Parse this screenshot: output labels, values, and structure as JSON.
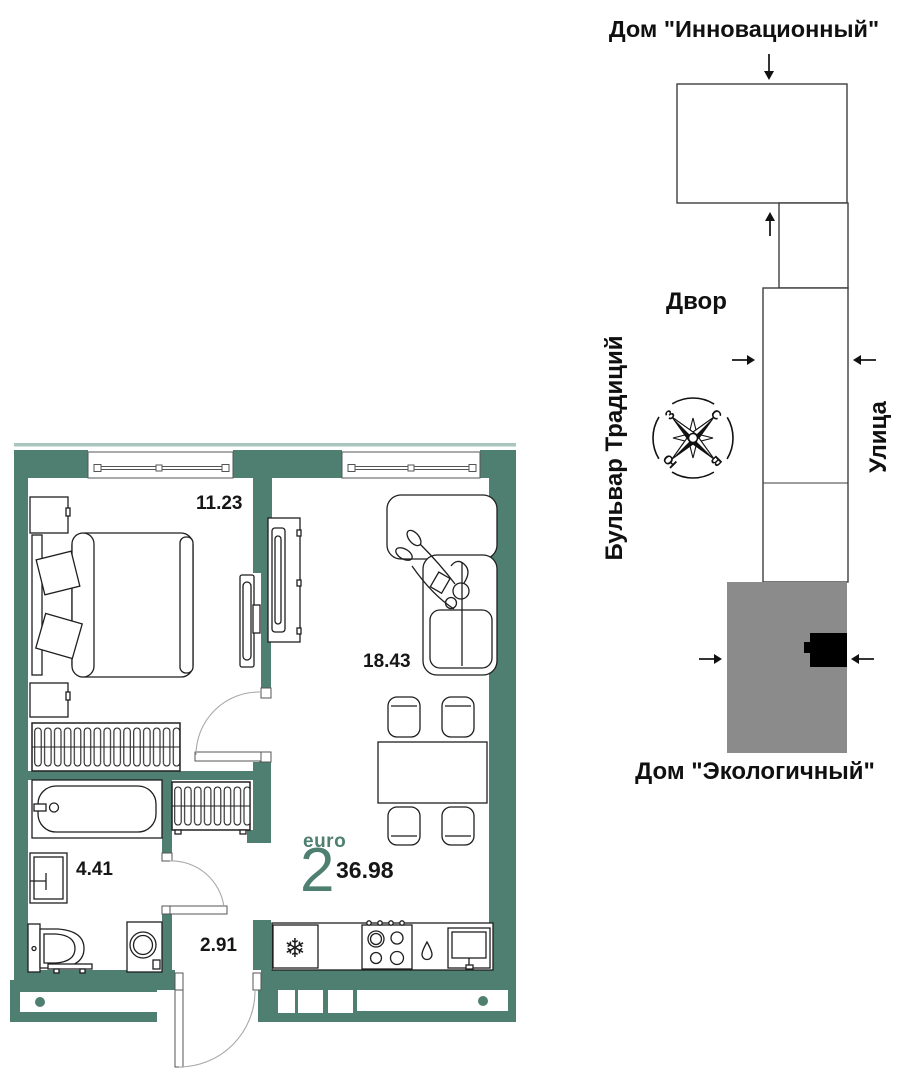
{
  "floorplan": {
    "bedroom_area": "11.23",
    "living_area": "18.43",
    "bathroom_area": "4.41",
    "hall_area": "2.91",
    "layout_type": "euro",
    "rooms_count": "2",
    "total_area": "36.98",
    "fridge_icon": "❄"
  },
  "sitemap": {
    "house_top_title": "Дом \"Инновационный\"",
    "yard_label": "Двор",
    "street_label": "Улица",
    "boulevard_label": "Бульвар Традиций",
    "house_bottom_title": "Дом \"Экологичный\"",
    "compass": {
      "north": "С",
      "east": "В",
      "south": "Ю",
      "west": "З"
    }
  },
  "colors": {
    "wall_teal": "#4E7F70",
    "wall_light_teal": "#A8C6BD",
    "building_gray": "#8B8B8B",
    "marker_black": "#000000",
    "accent_teal": "#4E7F70"
  }
}
